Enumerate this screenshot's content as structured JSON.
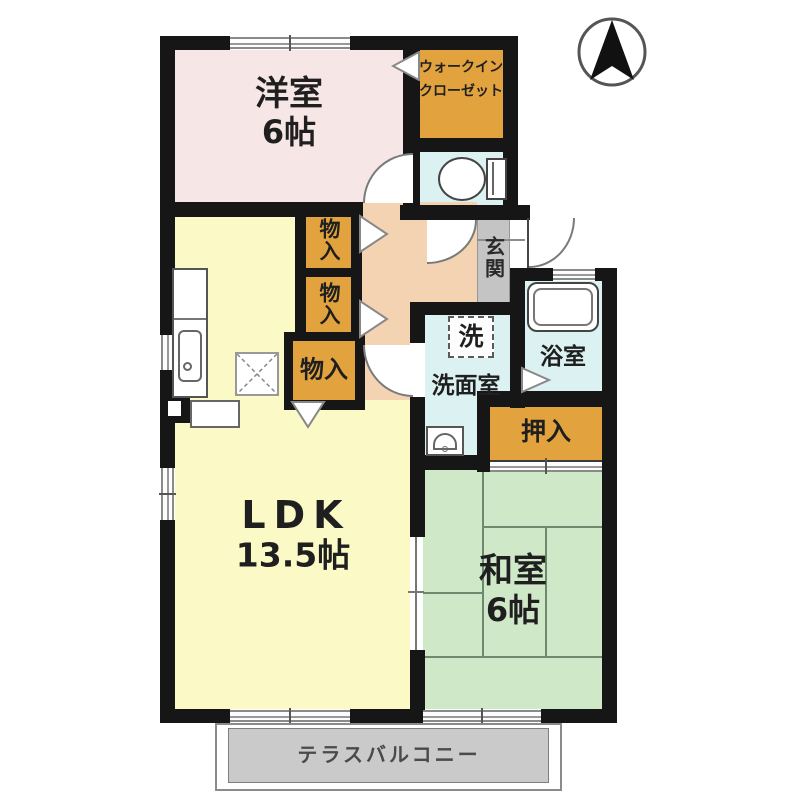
{
  "colors": {
    "wall": "#161616",
    "room-pink": "#f7e6e6",
    "closet-orange": "#e2a33f",
    "room-yellow": "#fbf9c6",
    "room-green": "#cfe9c8",
    "wet-cyan": "#dcf2f2",
    "hall-peach": "#f4d3b3",
    "genkan-gray": "#c4c4c4",
    "balcony-gray": "#cacaca",
    "tatami-line": "#6e8a6e"
  },
  "rooms": {
    "western_room": {
      "label": "洋室",
      "size": "6帖"
    },
    "walk_in_closet": {
      "label_line1": "ウォークイン",
      "label_line2": "クローゼット"
    },
    "ldk": {
      "label": "LDK",
      "size": "13.5帖"
    },
    "japanese_room": {
      "label": "和室",
      "size": "6帖"
    },
    "entrance": {
      "label": "玄関"
    },
    "washroom": {
      "label": "洗面室"
    },
    "laundry": {
      "label": "洗"
    },
    "bathroom": {
      "label": "浴室"
    },
    "oshiire_closet": {
      "label": "押入"
    },
    "storage1": {
      "label": "物入"
    },
    "storage2": {
      "label": "物入"
    },
    "storage3": {
      "label": "物入"
    },
    "terrace_balcony": {
      "label": "テラスバルコニー"
    }
  },
  "compass": {
    "direction": "N"
  }
}
